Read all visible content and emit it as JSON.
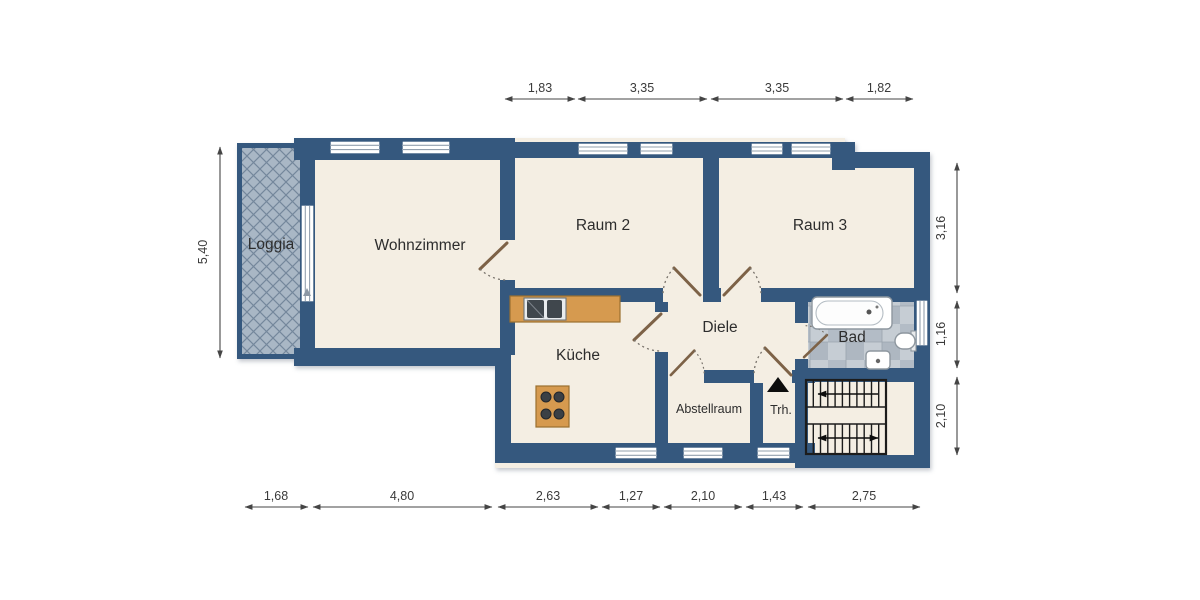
{
  "rooms": {
    "loggia": "Loggia",
    "wohnzimmer": "Wohnzimmer",
    "raum2": "Raum 2",
    "raum3": "Raum 3",
    "kueche": "Küche",
    "diele": "Diele",
    "bad": "Bad",
    "abstellraum": "Abstellraum",
    "treppenhaus": "Trh."
  },
  "dimensions": {
    "top": [
      "1,83",
      "3,35",
      "3,35",
      "1,82"
    ],
    "bottom": [
      "1,68",
      "4,80",
      "2,63",
      "1,27",
      "2,10",
      "1,43",
      "2,75"
    ],
    "left": [
      "5,40"
    ],
    "right": [
      "3,16",
      "1,16",
      "2,10"
    ]
  },
  "colors": {
    "wall": "#35597e",
    "floor": "#f4eee3",
    "loggia_fill": "#a9b7c5",
    "loggia_line": "#74879c",
    "tile_light": "#c9cfd6",
    "tile_dark": "#b2bac4",
    "wood": "#d69a4f",
    "door": "#7d6247",
    "dimension_text": "#3a3a3a",
    "label_text": "#2d2d2d"
  }
}
